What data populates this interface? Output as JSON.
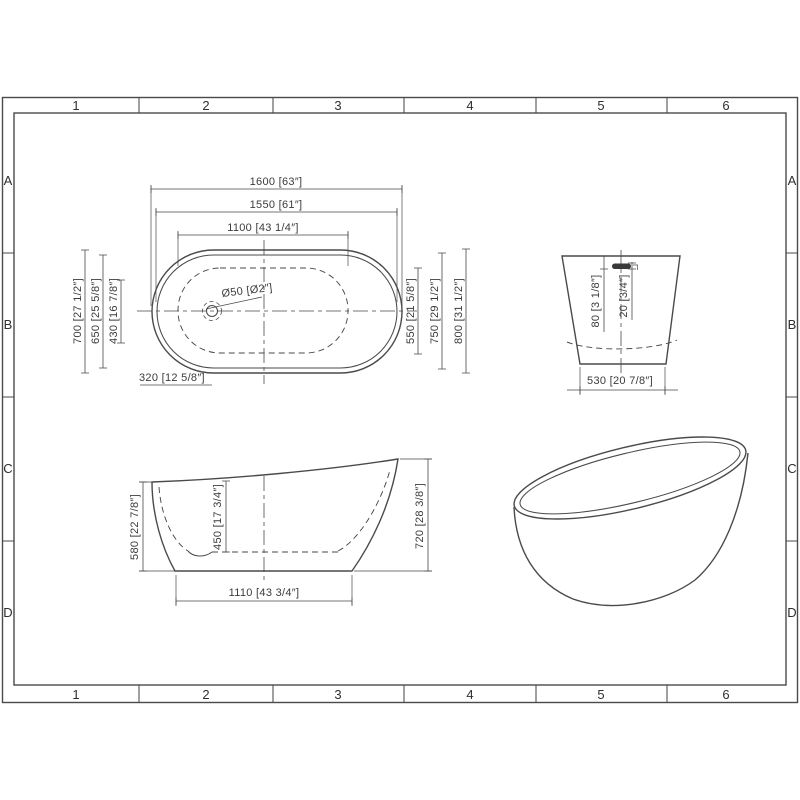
{
  "grid": {
    "cols": [
      "1",
      "2",
      "3",
      "4",
      "5",
      "6"
    ],
    "rows": [
      "A",
      "B",
      "C",
      "D"
    ]
  },
  "plan": {
    "d1600": "1600 [63″]",
    "d1550": "1550 [61″]",
    "d1100": "1100 [43 1/4″]",
    "d700": "700 [27 1/2″]",
    "d650": "650 [25 5/8″]",
    "d430": "430 [16 7/8″]",
    "d550": "550 [21 5/8″]",
    "d750": "750 [29 1/2″]",
    "d800": "800 [31 1/2″]",
    "d320": "320 [12 5/8″]",
    "drain": "Ø50 [Ø2″]"
  },
  "end": {
    "d80": "80 [3 1/8″]",
    "d20": "20 [3/4″]",
    "d530": "530 [20 7/8″]"
  },
  "side": {
    "d580": "580 [22 7/8″]",
    "d450": "450 [17 3/4″]",
    "d720": "720 [28 3/8″]",
    "d1110": "1110 [43 3/4″]"
  },
  "colors": {
    "line": "#4a4a4a",
    "text": "#3b3b3b",
    "background": "#ffffff"
  }
}
